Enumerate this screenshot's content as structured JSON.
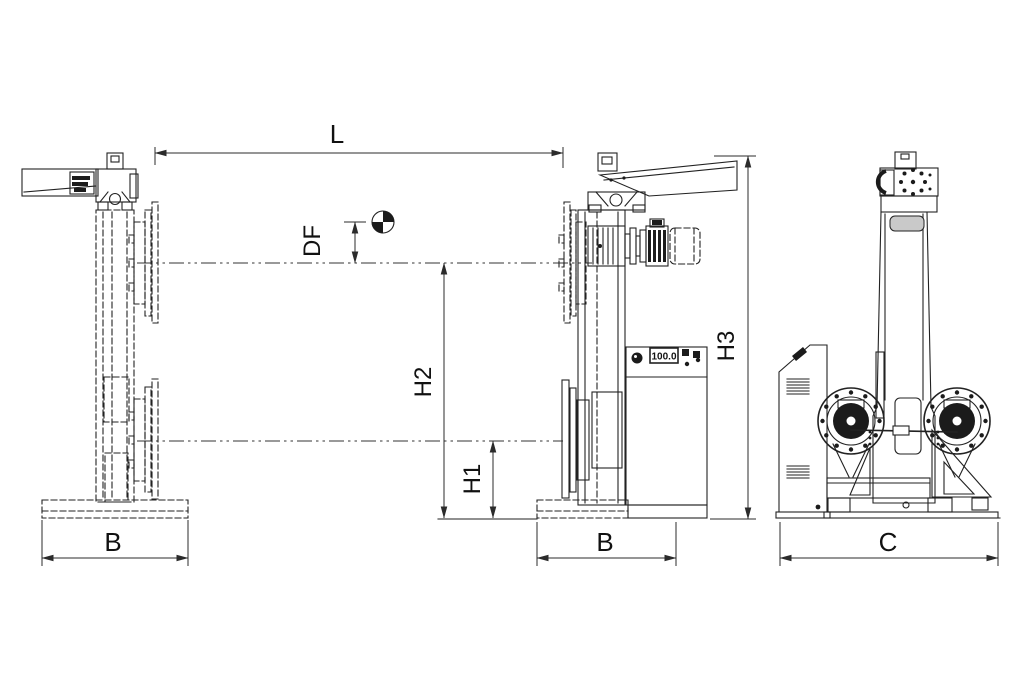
{
  "meta": {
    "background": "#ffffff",
    "line_color": "#222222",
    "dark_fill": "#1b1b1b",
    "slot_gray": "#c9c9c9"
  },
  "dimensions": {
    "l": "L",
    "df": "DF",
    "h1": "H1",
    "h2": "H2",
    "h3": "H3",
    "b_left": "B",
    "b_middle": "B",
    "c": "C"
  },
  "headstock": {
    "control_panel": {
      "display_value": "100.0"
    }
  },
  "symbols": {
    "center_of_gravity": "center-of-gravity-icon"
  }
}
